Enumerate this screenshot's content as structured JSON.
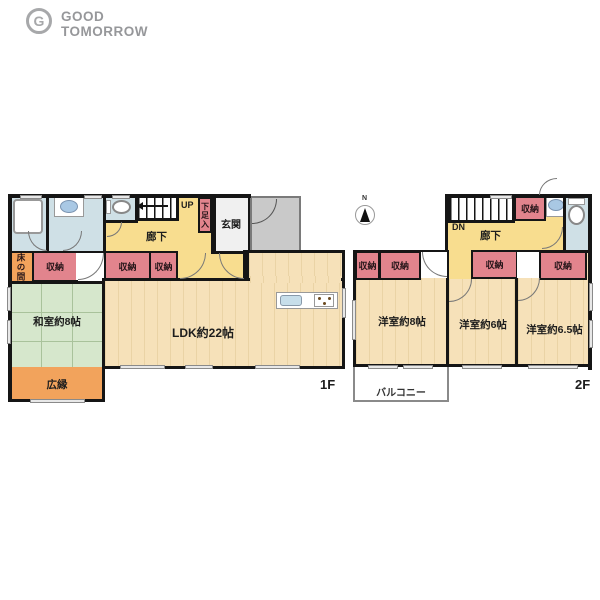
{
  "logo": {
    "icon_letter": "G",
    "line1": "GOOD",
    "line2": "TOMORROW"
  },
  "compass": {
    "north": "N"
  },
  "floor1": {
    "floor_label": "1F",
    "tokonoma": "床の間",
    "storage": "収納",
    "corridor": "廊下",
    "up": "UP",
    "shoe_box": "下足入",
    "entrance": "玄関",
    "washitsu": "和室約8帖",
    "ldk": "LDK約22帖",
    "veranda": "広縁"
  },
  "floor2": {
    "floor_label": "2F",
    "down": "DN",
    "corridor": "廊下",
    "storage": "収納",
    "room8": "洋室約8帖",
    "room6": "洋室約6帖",
    "room65": "洋室約6.5帖",
    "balcony": "バルコニー"
  },
  "colors": {
    "wall": "#151515",
    "corridor_yellow": "#F8DD8F",
    "storage_pink": "#E2848D",
    "tatami_green": "#D6E7CC",
    "wood_beige": "#F6E1B9",
    "wet_area_blue": "#CFE0E6",
    "accent_orange": "#F2A35C",
    "porch_gray": "#C9C9C9",
    "logo_gray": "#97989A"
  }
}
